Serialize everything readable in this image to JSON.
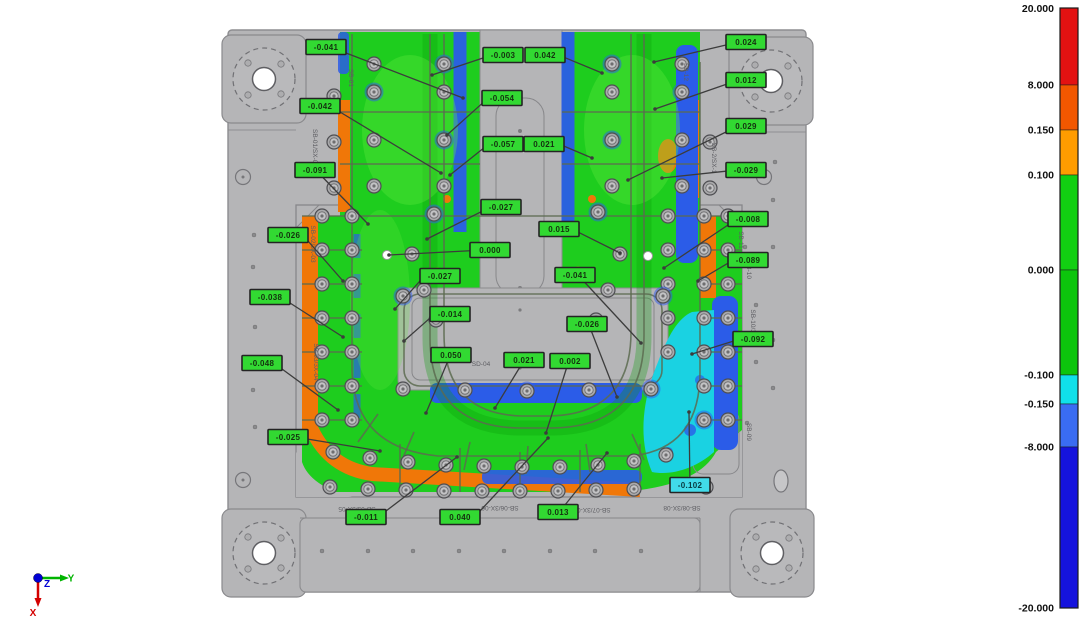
{
  "colors": {
    "field_green": "#1ecd1e",
    "field_orange": "#f07708",
    "field_blue": "#2b5ce8",
    "field_cyan": "#1ad2e2",
    "plate": "#b5b5b7",
    "plate_line": "#87878a",
    "label_green_bg": "#32d932",
    "label_cyan_bg": "#41dbe9",
    "label_border": "#242424",
    "label_text": "#14320f",
    "leader": "#3c3c3c"
  },
  "colorbar": {
    "x": 1060,
    "width": 18,
    "top": 8,
    "bottom": 608,
    "segments": [
      {
        "color": "#e31212",
        "y1": 8,
        "y2": 85
      },
      {
        "color": "#f25700",
        "y1": 85,
        "y2": 130
      },
      {
        "color": "#ff9c00",
        "y1": 130,
        "y2": 175
      },
      {
        "color": "#12cf12",
        "y1": 175,
        "y2": 270
      },
      {
        "color": "#0cc50c",
        "y1": 270,
        "y2": 375
      },
      {
        "color": "#10e0ea",
        "y1": 375,
        "y2": 404
      },
      {
        "color": "#3a6cf2",
        "y1": 404,
        "y2": 447
      },
      {
        "color": "#1513dc",
        "y1": 447,
        "y2": 608
      }
    ],
    "ticks": [
      {
        "label": "20.000",
        "y": 8
      },
      {
        "label": "8.000",
        "y": 85
      },
      {
        "label": "0.150",
        "y": 130
      },
      {
        "label": "0.100",
        "y": 175
      },
      {
        "label": "0.000",
        "y": 270
      },
      {
        "label": "-0.100",
        "y": 375
      },
      {
        "label": "-0.150",
        "y": 404
      },
      {
        "label": "-8.000",
        "y": 447
      },
      {
        "label": "-20.000",
        "y": 608
      }
    ]
  },
  "triad": {
    "x": {
      "label": "X",
      "color": "#d40000"
    },
    "y": {
      "label": "Y",
      "color": "#00b400"
    },
    "z": {
      "label": "Z",
      "color": "#0000d4"
    }
  },
  "deviation_labels": [
    {
      "value": "-0.041",
      "x": 326,
      "y": 47,
      "tx": 463,
      "ty": 98,
      "style": "green"
    },
    {
      "value": "-0.003",
      "x": 503,
      "y": 55,
      "tx": 432,
      "ty": 75,
      "style": "green"
    },
    {
      "value": "0.042",
      "x": 545,
      "y": 55,
      "tx": 602,
      "ty": 73,
      "style": "green"
    },
    {
      "value": "0.024",
      "x": 746,
      "y": 42,
      "tx": 654,
      "ty": 62,
      "style": "green"
    },
    {
      "value": "-0.054",
      "x": 502,
      "y": 98,
      "tx": 447,
      "ty": 135,
      "style": "green"
    },
    {
      "value": "0.012",
      "x": 746,
      "y": 80,
      "tx": 655,
      "ty": 109,
      "style": "green"
    },
    {
      "value": "-0.042",
      "x": 320,
      "y": 106,
      "tx": 441,
      "ty": 173,
      "style": "green"
    },
    {
      "value": "0.029",
      "x": 746,
      "y": 126,
      "tx": 628,
      "ty": 180,
      "style": "green"
    },
    {
      "value": "-0.057",
      "x": 503,
      "y": 144,
      "tx": 450,
      "ty": 175,
      "style": "green"
    },
    {
      "value": "0.021",
      "x": 544,
      "y": 144,
      "tx": 592,
      "ty": 158,
      "style": "green"
    },
    {
      "value": "-0.091",
      "x": 315,
      "y": 170,
      "tx": 368,
      "ty": 224,
      "style": "green"
    },
    {
      "value": "-0.029",
      "x": 746,
      "y": 170,
      "tx": 662,
      "ty": 178,
      "style": "green"
    },
    {
      "value": "-0.027",
      "x": 501,
      "y": 207,
      "tx": 427,
      "ty": 239,
      "style": "green"
    },
    {
      "value": "0.015",
      "x": 559,
      "y": 229,
      "tx": 620,
      "ty": 253,
      "style": "green"
    },
    {
      "value": "-0.008",
      "x": 748,
      "y": 219,
      "tx": 664,
      "ty": 268,
      "style": "green"
    },
    {
      "value": "-0.026",
      "x": 288,
      "y": 235,
      "tx": 343,
      "ty": 281,
      "style": "green"
    },
    {
      "value": "0.000",
      "x": 490,
      "y": 250,
      "tx": 389,
      "ty": 255,
      "style": "green"
    },
    {
      "value": "-0.089",
      "x": 748,
      "y": 260,
      "tx": 698,
      "ty": 281,
      "style": "green"
    },
    {
      "value": "-0.038",
      "x": 270,
      "y": 297,
      "tx": 343,
      "ty": 337,
      "style": "green"
    },
    {
      "value": "-0.027",
      "x": 440,
      "y": 276,
      "tx": 395,
      "ty": 309,
      "style": "green"
    },
    {
      "value": "-0.041",
      "x": 575,
      "y": 275,
      "tx": 641,
      "ty": 343,
      "style": "green"
    },
    {
      "value": "-0.014",
      "x": 450,
      "y": 314,
      "tx": 404,
      "ty": 341,
      "style": "green"
    },
    {
      "value": "-0.026",
      "x": 587,
      "y": 324,
      "tx": 617,
      "ty": 397,
      "style": "green"
    },
    {
      "value": "-0.092",
      "x": 753,
      "y": 339,
      "tx": 692,
      "ty": 354,
      "style": "green"
    },
    {
      "value": "-0.048",
      "x": 262,
      "y": 363,
      "tx": 338,
      "ty": 410,
      "style": "green"
    },
    {
      "value": "0.050",
      "x": 451,
      "y": 355,
      "tx": 426,
      "ty": 413,
      "style": "green"
    },
    {
      "value": "0.021",
      "x": 524,
      "y": 360,
      "tx": 495,
      "ty": 408,
      "style": "green"
    },
    {
      "value": "0.002",
      "x": 570,
      "y": 361,
      "tx": 546,
      "ty": 433,
      "style": "green"
    },
    {
      "value": "-0.025",
      "x": 288,
      "y": 437,
      "tx": 380,
      "ty": 451,
      "style": "green"
    },
    {
      "value": "-0.011",
      "x": 366,
      "y": 517,
      "tx": 457,
      "ty": 457,
      "style": "green"
    },
    {
      "value": "0.040",
      "x": 460,
      "y": 517,
      "tx": 548,
      "ty": 438,
      "style": "green"
    },
    {
      "value": "0.013",
      "x": 558,
      "y": 512,
      "tx": 607,
      "ty": 453,
      "style": "green"
    },
    {
      "value": "-0.102",
      "x": 690,
      "y": 485,
      "tx": 689,
      "ty": 412,
      "style": "cyan"
    }
  ],
  "part": {
    "texts": [
      {
        "text": "SB-01",
        "x": 349,
        "y": 78,
        "rot": 90
      },
      {
        "text": "SB-01/SX-02",
        "x": 313,
        "y": 148,
        "rot": 90
      },
      {
        "text": "SB-12",
        "x": 684,
        "y": 72,
        "rot": 90
      },
      {
        "text": "SB-2/SX-1",
        "x": 712,
        "y": 158,
        "rot": 90
      },
      {
        "text": "SB-02/3X-03",
        "x": 311,
        "y": 244,
        "rot": 90
      },
      {
        "text": "SB-03/3X-04",
        "x": 314,
        "y": 362,
        "rot": 90
      },
      {
        "text": "SB-11",
        "x": 739,
        "y": 240,
        "rot": 90
      },
      {
        "text": "SB-10",
        "x": 747,
        "y": 270,
        "rot": 90
      },
      {
        "text": "SB-10/3X-10",
        "x": 751,
        "y": 328,
        "rot": 90
      },
      {
        "text": "SB-09",
        "x": 747,
        "y": 432,
        "rot": 90
      },
      {
        "text": "SB-05/3X-05",
        "x": 357,
        "y": 507,
        "rot": 180
      },
      {
        "text": "SB-06/3X-06",
        "x": 500,
        "y": 506,
        "rot": 180
      },
      {
        "text": "SB-07/3X-07",
        "x": 592,
        "y": 508,
        "rot": 180
      },
      {
        "text": "SB-08/3X-08",
        "x": 682,
        "y": 506,
        "rot": 180
      },
      {
        "text": "SD-04",
        "x": 481,
        "y": 366,
        "rot": 0
      }
    ],
    "ref_points": [
      {
        "x": 387,
        "y": 255
      },
      {
        "x": 648,
        "y": 256
      }
    ],
    "screws": [
      [
        374,
        64,
        0
      ],
      [
        444,
        64,
        1
      ],
      [
        612,
        64,
        1
      ],
      [
        682,
        64,
        0
      ],
      [
        374,
        92,
        1
      ],
      [
        444,
        92,
        0
      ],
      [
        612,
        92,
        0
      ],
      [
        682,
        92,
        1
      ],
      [
        334,
        96,
        0
      ],
      [
        334,
        142,
        0
      ],
      [
        334,
        188,
        0
      ],
      [
        374,
        140,
        0
      ],
      [
        444,
        140,
        1
      ],
      [
        612,
        140,
        1
      ],
      [
        682,
        140,
        0
      ],
      [
        374,
        186,
        0
      ],
      [
        444,
        186,
        0
      ],
      [
        612,
        186,
        0
      ],
      [
        682,
        186,
        0
      ],
      [
        710,
        142,
        0
      ],
      [
        710,
        188,
        0
      ],
      [
        322,
        216,
        0
      ],
      [
        352,
        216,
        0
      ],
      [
        322,
        250,
        0
      ],
      [
        352,
        250,
        0
      ],
      [
        322,
        284,
        0
      ],
      [
        352,
        284,
        0
      ],
      [
        322,
        318,
        0
      ],
      [
        352,
        318,
        0
      ],
      [
        322,
        352,
        0
      ],
      [
        352,
        352,
        0
      ],
      [
        322,
        386,
        0
      ],
      [
        352,
        386,
        0
      ],
      [
        322,
        420,
        0
      ],
      [
        352,
        420,
        0
      ],
      [
        704,
        216,
        0
      ],
      [
        728,
        216,
        0
      ],
      [
        704,
        250,
        0
      ],
      [
        728,
        250,
        0
      ],
      [
        704,
        284,
        0
      ],
      [
        728,
        284,
        0
      ],
      [
        704,
        318,
        0
      ],
      [
        728,
        318,
        0
      ],
      [
        704,
        352,
        0
      ],
      [
        728,
        352,
        0
      ],
      [
        704,
        386,
        0
      ],
      [
        728,
        386,
        0
      ],
      [
        704,
        420,
        1
      ],
      [
        728,
        420,
        0
      ],
      [
        434,
        214,
        1
      ],
      [
        598,
        212,
        1
      ],
      [
        668,
        216,
        0
      ],
      [
        412,
        254,
        0
      ],
      [
        620,
        254,
        0
      ],
      [
        668,
        250,
        0
      ],
      [
        424,
        290,
        0
      ],
      [
        608,
        290,
        0
      ],
      [
        668,
        284,
        0
      ],
      [
        436,
        320,
        0
      ],
      [
        596,
        320,
        0
      ],
      [
        668,
        318,
        0
      ],
      [
        668,
        352,
        0
      ],
      [
        403,
        296,
        1
      ],
      [
        663,
        296,
        1
      ],
      [
        403,
        389,
        0
      ],
      [
        465,
        390,
        0
      ],
      [
        527,
        391,
        1
      ],
      [
        589,
        390,
        0
      ],
      [
        651,
        389,
        1
      ],
      [
        333,
        452,
        0
      ],
      [
        370,
        458,
        0
      ],
      [
        408,
        462,
        0
      ],
      [
        446,
        465,
        0
      ],
      [
        484,
        466,
        0
      ],
      [
        522,
        467,
        0
      ],
      [
        560,
        467,
        0
      ],
      [
        598,
        465,
        0
      ],
      [
        634,
        461,
        0
      ],
      [
        666,
        455,
        0
      ],
      [
        330,
        487,
        0
      ],
      [
        368,
        489,
        0
      ],
      [
        406,
        490,
        0
      ],
      [
        444,
        491,
        0
      ],
      [
        482,
        491,
        0
      ],
      [
        520,
        491,
        0
      ],
      [
        558,
        491,
        0
      ],
      [
        596,
        490,
        0
      ],
      [
        634,
        489,
        0
      ],
      [
        706,
        487,
        0
      ]
    ],
    "small_holes": [
      [
        254,
        235
      ],
      [
        253,
        267
      ],
      [
        255,
        327
      ],
      [
        253,
        390
      ],
      [
        255,
        427
      ],
      [
        775,
        162
      ],
      [
        773,
        200
      ],
      [
        745,
        247
      ],
      [
        773,
        247
      ],
      [
        756,
        305
      ],
      [
        773,
        340
      ],
      [
        756,
        362
      ],
      [
        773,
        388
      ],
      [
        747,
        423
      ],
      [
        322,
        551
      ],
      [
        368,
        551
      ],
      [
        413,
        551
      ],
      [
        459,
        551
      ],
      [
        504,
        551
      ],
      [
        550,
        551
      ],
      [
        595,
        551
      ],
      [
        641,
        551
      ]
    ],
    "edge_holes": [
      [
        243,
        177
      ],
      [
        243,
        480
      ],
      [
        764,
        177
      ]
    ],
    "oval_hole": {
      "x": 781,
      "y": 481,
      "rx": 7,
      "ry": 11
    }
  }
}
